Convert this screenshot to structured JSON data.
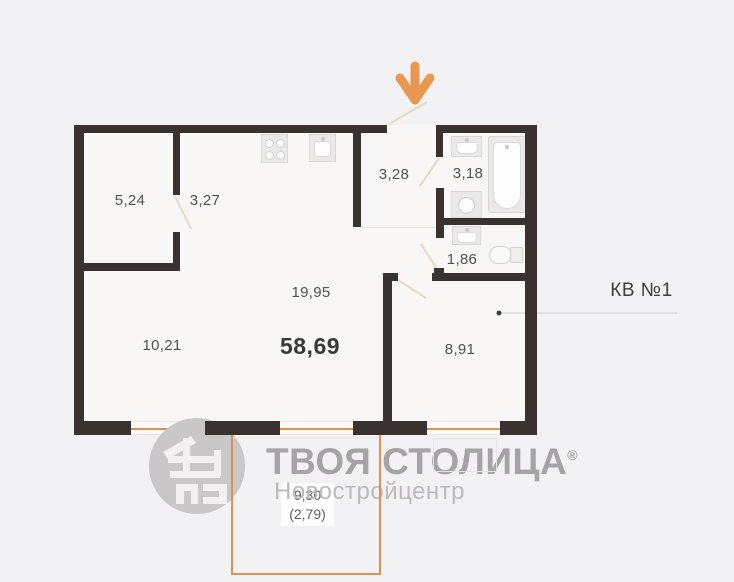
{
  "plan": {
    "apartment_label": "КВ №1",
    "total_area": "58,69",
    "rooms": {
      "wardrobe": "5,24",
      "corridor": "3,27",
      "entry_hall": "3,28",
      "bathroom": "3,18",
      "wc": "1,86",
      "kitchen_living": "19,95",
      "sleeping_zone": "10,21",
      "bedroom": "8,91"
    },
    "balcony": {
      "area": "9,30",
      "area_reduced": "(2,79)"
    }
  },
  "watermark": {
    "brand": "ТВОЯ СТОЛИЦА",
    "registered": "®",
    "subtitle": "Новостройцентр"
  },
  "icons": {
    "entrance_arrow": "arrow-down",
    "stove": "stove-4-burners",
    "kitchen_sink": "sink",
    "washbasin": "washbasin",
    "bathtub": "bathtub",
    "washing_machine": "washing-machine",
    "wc_sink": "washbasin-small",
    "toilet": "toilet"
  },
  "colors": {
    "wall": "#39322f",
    "accent_orange": "#e0914d",
    "arrow_orange": "#e9994f",
    "floor": "#f8f7f5",
    "background": "#f2f2f4",
    "watermark_gray": "#a5a3a3"
  }
}
